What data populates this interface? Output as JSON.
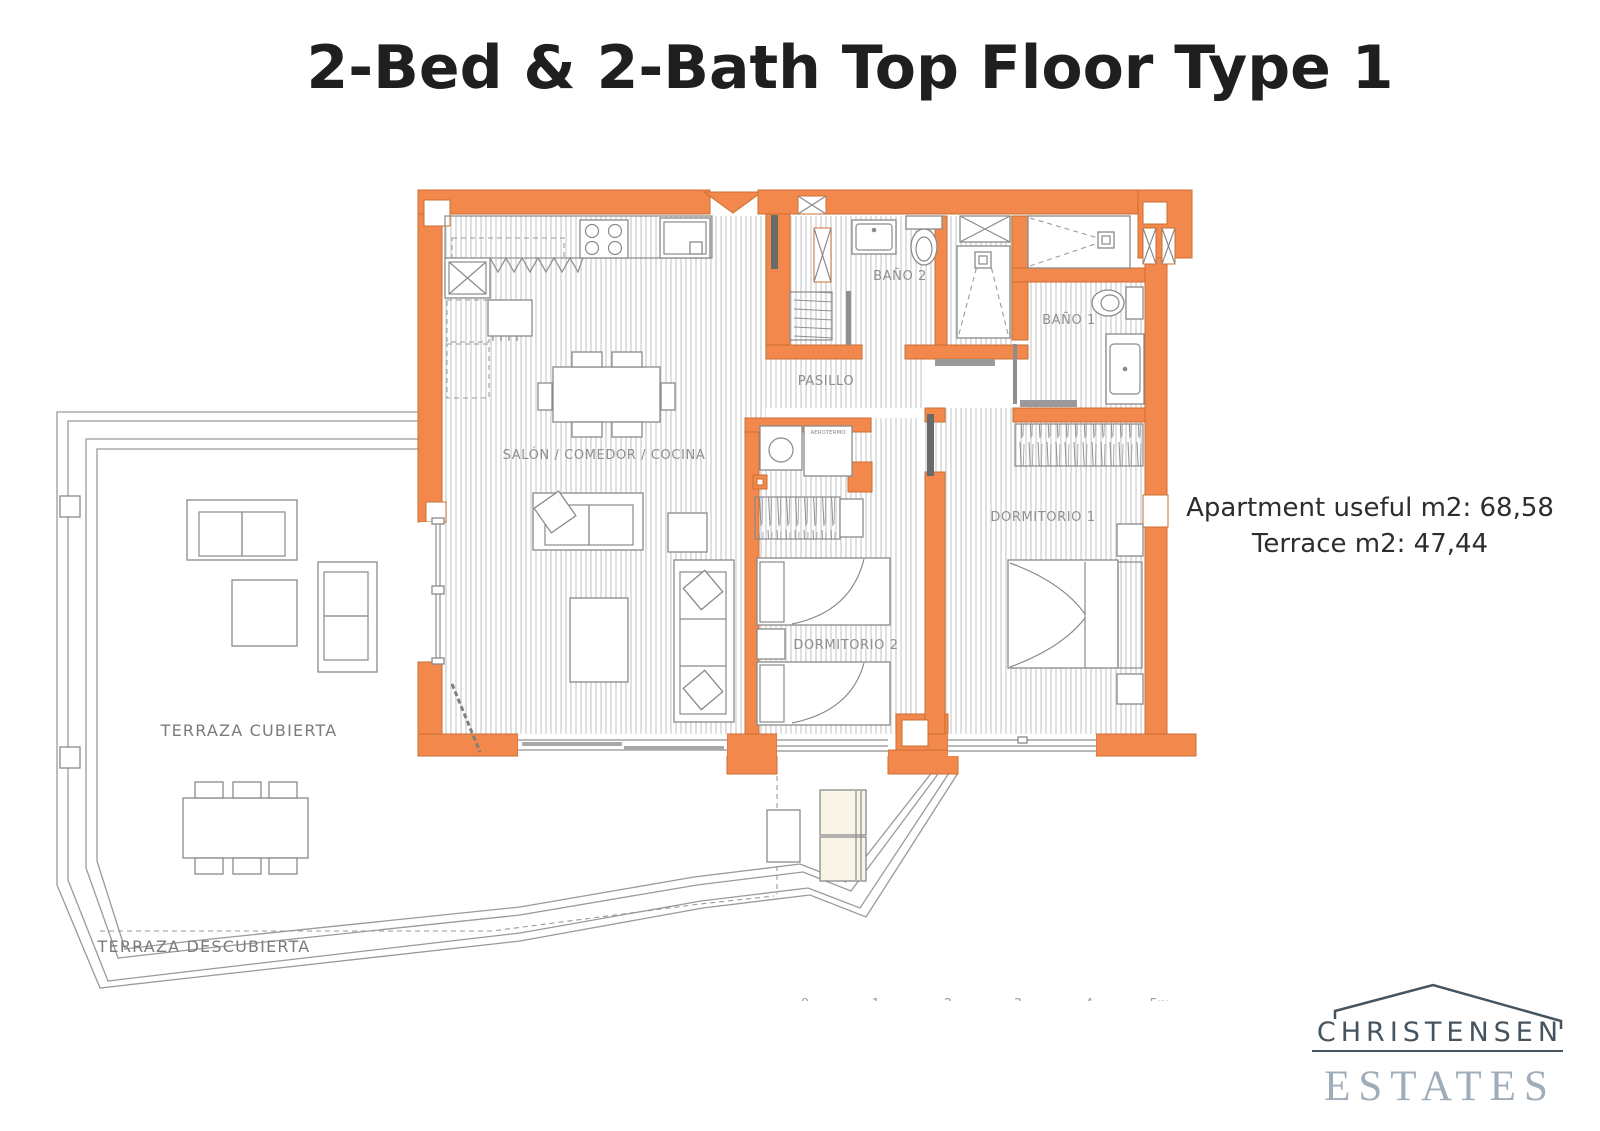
{
  "page": {
    "title": "2-Bed & 2-Bath Top Floor Type 1"
  },
  "info": {
    "apartment_area": "Apartment useful m2: 68,58",
    "terrace_area": "Terrace m2: 47,44"
  },
  "floor_plan": {
    "rooms": {
      "salon": {
        "label": "SALÓN / COMEDOR / COCINA"
      },
      "pasillo": {
        "label": "PASILLO"
      },
      "bano2": {
        "label": "BAÑO 2"
      },
      "bano1": {
        "label": "BAÑO 1"
      },
      "dormitorio1": {
        "label": "DORMITORIO 1"
      },
      "dormitorio2": {
        "label": "DORMITORIO 2"
      },
      "terraza_cubierta": {
        "label": "TERRAZA CUBIERTA"
      },
      "terraza_descubierta": {
        "label": "TERRAZA DESCUBIERTA"
      },
      "aerotermo": {
        "label": "AEROTERMO"
      }
    },
    "scale_bar": {
      "labels": [
        "0",
        "1",
        "2",
        "3",
        "4",
        "5m"
      ]
    }
  },
  "logo": {
    "name": "CHRISTENSEN",
    "subname": "ESTATES"
  },
  "colors": {
    "wall_fill": "#f2884b",
    "wall_stroke": "#c96f33",
    "floor_hatch": "#d6d6d6",
    "furniture_line": "#8a8a8a",
    "label_gray": "#8f8f8f",
    "logo_dark": "#45545f",
    "logo_light": "#9fadba",
    "title_color": "#1f1f1f"
  }
}
